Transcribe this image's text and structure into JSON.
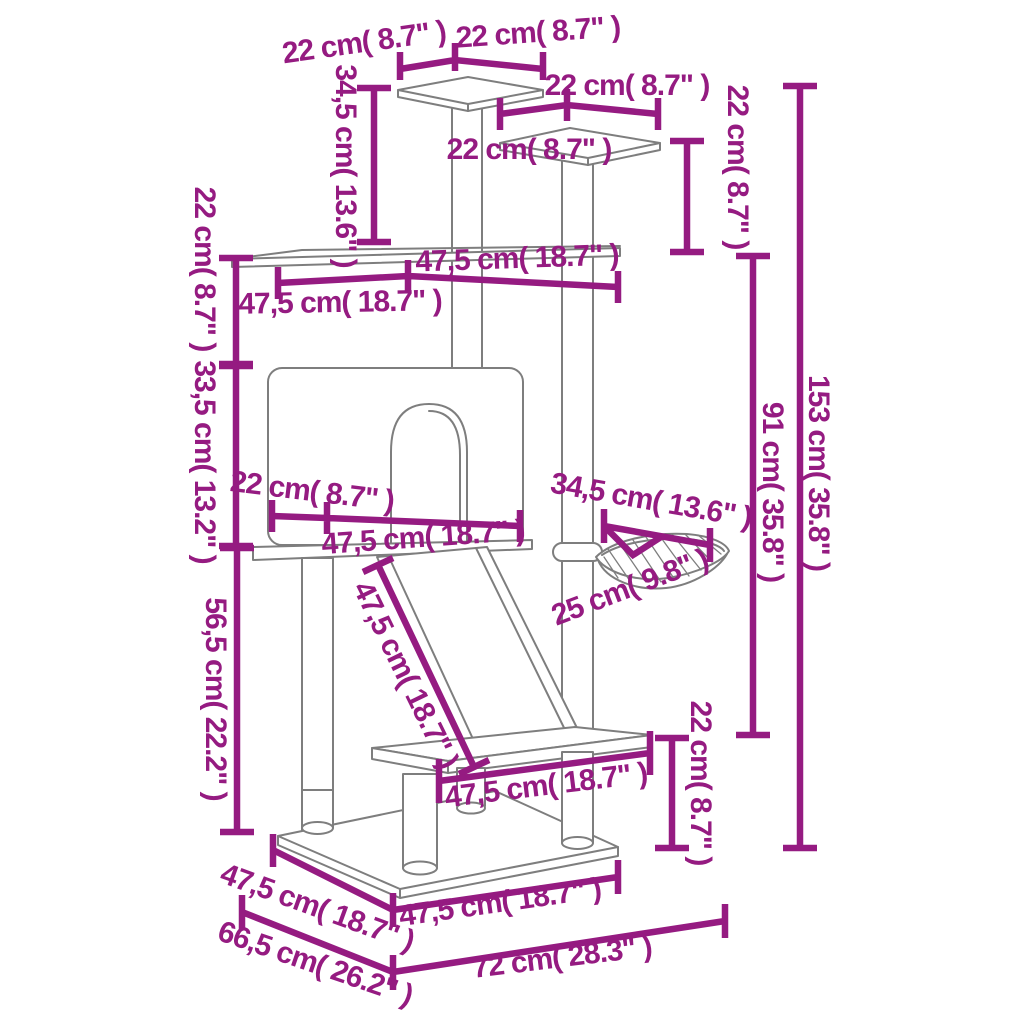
{
  "diagram": {
    "type": "product-dimension-diagram",
    "subject": "cat tree tower line drawing with scratching posts, condo, ramp and hammock",
    "unit_primary": "cm",
    "unit_secondary": "in",
    "colors": {
      "annotation": "#951b81",
      "outline": "#7e7e7e",
      "background": "#ffffff"
    },
    "labels": {
      "d01": "22 cm( 8.7\" )",
      "d02": "22 cm( 8.7\" )",
      "d03": "22 cm( 8.7\" )",
      "d04": "22 cm( 8.7\" )",
      "d05": "22 cm( 8.7\" )",
      "d06": "34,5 cm( 13.6\" )",
      "d07": "22 cm( 8.7\" )",
      "d08": "47,5 cm( 18.7\" )",
      "d09": "47,5 cm( 18.7\" )",
      "d10": "33,5 cm( 13.2\" )",
      "d11": "22 cm( 8.7\" )",
      "d12": "47,5 cm( 18.7\" )",
      "d13": "34,5 cm( 13.6\" )",
      "d14": "25 cm( 9.8\" )",
      "d15": "91 cm( 35.8\" )",
      "d16": "153 cm( 35.8\" )",
      "d17": "56,5 cm( 22.2\" )",
      "d18": "47,5 cm( 18.7\" )",
      "d19": "47,5 cm( 18.7\" )",
      "d20": "22 cm( 8.7\" )",
      "d21": "47,5 cm( 18.7\" )",
      "d22": "47,5 cm( 18.7\" )",
      "d23": "66,5 cm( 26.2\" )",
      "d24": "72 cm( 28.3\" )"
    }
  }
}
